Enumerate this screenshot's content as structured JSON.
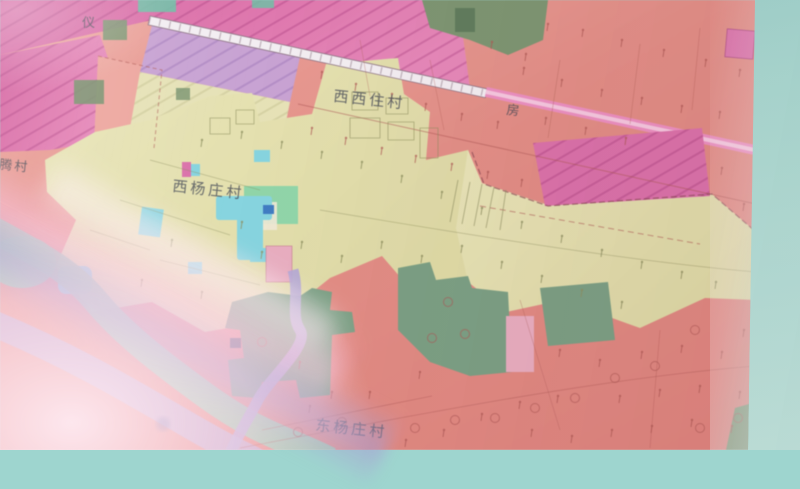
{
  "palette": {
    "backdrop": "#a9dcd4",
    "salmon": "#e58e86",
    "salmon_light": "#efa79e",
    "magenta": "#dd71ab",
    "lavender": "#c9a3d4",
    "pale_yellow": "#e6e2b6",
    "village_yellow": "#e6e2b0",
    "olive_green": "#7c9671",
    "sage_green": "#7aa083",
    "park_green": "#8fd6a8",
    "cyan_water": "#85d4e0",
    "river_teal": "#95ccb1",
    "road_pink": "#ee8fc2",
    "road_pink_light": "#f7c9e0",
    "rail_white": "#f3eef2",
    "purple_road": "#b2a6d6",
    "pink_patch": "#e9aec0",
    "line_red": "#b05a55",
    "line_olive": "#8e9060",
    "boundary_dark": "#8a4a52",
    "label_dark": "#474c58"
  },
  "labels": {
    "yi": {
      "text": "仪"
    },
    "xixizhucun": {
      "text": "西西住村"
    },
    "fang": {
      "text": "房"
    },
    "xiyangzhuangcun": {
      "text": "西杨庄村"
    },
    "dongyangzhuangcun": {
      "text": "东杨庄村"
    },
    "liutengcun": {
      "text": "刘腾村"
    }
  },
  "symbols": {
    "farmland_ticks": [
      [
        583,
        30
      ],
      [
        622,
        40
      ],
      [
        664,
        50
      ],
      [
        706,
        60
      ],
      [
        740,
        70
      ],
      [
        548,
        24
      ],
      [
        524,
        68
      ],
      [
        562,
        80
      ],
      [
        602,
        90
      ],
      [
        642,
        98
      ],
      [
        682,
        106
      ],
      [
        720,
        112
      ],
      [
        322,
        72
      ],
      [
        356,
        84
      ],
      [
        392,
        94
      ],
      [
        426,
        104
      ],
      [
        462,
        114
      ],
      [
        498,
        122
      ],
      [
        312,
        128
      ],
      [
        346,
        138
      ],
      [
        382,
        148
      ],
      [
        416,
        156
      ],
      [
        452,
        164
      ],
      [
        488,
        172
      ],
      [
        522,
        180
      ],
      [
        546,
        118
      ],
      [
        586,
        128
      ],
      [
        626,
        138
      ],
      [
        492,
        42
      ],
      [
        526,
        54
      ],
      [
        722,
        168
      ],
      [
        744,
        204
      ],
      [
        560,
        350
      ],
      [
        600,
        360
      ],
      [
        642,
        352
      ],
      [
        682,
        346
      ],
      [
        722,
        352
      ],
      [
        744,
        330
      ],
      [
        620,
        396
      ],
      [
        660,
        390
      ],
      [
        700,
        386
      ],
      [
        740,
        392
      ],
      [
        558,
        396
      ],
      [
        520,
        402
      ],
      [
        482,
        414
      ],
      [
        444,
        430
      ],
      [
        406,
        440
      ],
      [
        532,
        430
      ],
      [
        572,
        436
      ],
      [
        612,
        430
      ],
      [
        652,
        426
      ],
      [
        692,
        420
      ],
      [
        732,
        426
      ],
      [
        310,
        406
      ],
      [
        370,
        392
      ],
      [
        420,
        372
      ],
      [
        300,
        362
      ],
      [
        332,
        392
      ]
    ],
    "village_ticks": [
      [
        202,
        140
      ],
      [
        242,
        132
      ],
      [
        282,
        142
      ],
      [
        322,
        152
      ],
      [
        362,
        162
      ],
      [
        402,
        176
      ],
      [
        442,
        192
      ],
      [
        482,
        208
      ],
      [
        522,
        222
      ],
      [
        562,
        236
      ],
      [
        602,
        250
      ],
      [
        642,
        262
      ],
      [
        682,
        272
      ],
      [
        716,
        282
      ],
      [
        172,
        240
      ],
      [
        142,
        280
      ],
      [
        202,
        292
      ],
      [
        242,
        222
      ],
      [
        262,
        252
      ],
      [
        302,
        242
      ],
      [
        342,
        256
      ],
      [
        382,
        242
      ],
      [
        422,
        256
      ],
      [
        462,
        246
      ],
      [
        502,
        262
      ],
      [
        542,
        276
      ],
      [
        582,
        290
      ],
      [
        622,
        302
      ]
    ],
    "orchard_circles": [
      [
        695,
        330
      ],
      [
        655,
        366
      ],
      [
        615,
        378
      ],
      [
        575,
        398
      ],
      [
        535,
        408
      ],
      [
        495,
        418
      ],
      [
        455,
        420
      ],
      [
        700,
        428
      ],
      [
        738,
        418
      ],
      [
        415,
        428
      ],
      [
        448,
        302
      ],
      [
        432,
        338
      ],
      [
        465,
        334
      ],
      [
        298,
        432
      ],
      [
        342,
        422
      ],
      [
        262,
        342
      ]
    ]
  }
}
